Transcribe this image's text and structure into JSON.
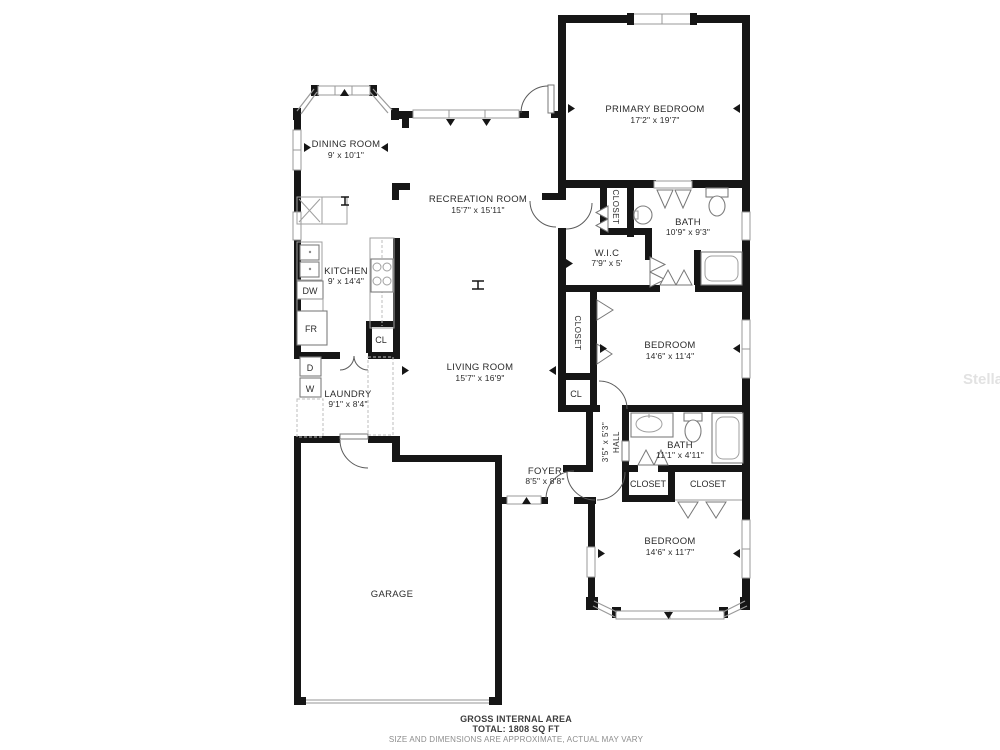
{
  "rooms": {
    "dining": {
      "name": "DINING ROOM",
      "dims": "9' x 10'1\""
    },
    "recreation": {
      "name": "RECREATION ROOM",
      "dims": "15'7\" x 15'11\""
    },
    "primary": {
      "name": "PRIMARY BEDROOM",
      "dims": "17'2\" x 19'7\""
    },
    "primary_closet": {
      "name": "CLOSET"
    },
    "primary_bath": {
      "name": "BATH",
      "dims": "10'9\" x 9'3\""
    },
    "wic": {
      "name": "W.I.C",
      "dims": "7'9\" x 5'"
    },
    "kitchen": {
      "name": "KITCHEN",
      "dims": "9' x 14'4\""
    },
    "kitchen_cl": {
      "name": "CL"
    },
    "living": {
      "name": "LIVING ROOM",
      "dims": "15'7\" x 16'9\""
    },
    "laundry": {
      "name": "LAUNDRY",
      "dims": "9'1\" x 8'4\""
    },
    "hall_closet": {
      "name": "CLOSET"
    },
    "hall_cl": {
      "name": "CL"
    },
    "bedroom2": {
      "name": "BEDROOM",
      "dims": "14'6\" x 11'4\""
    },
    "hall": {
      "name": "HALL",
      "dims": "3'5\" x 5'3\""
    },
    "bath2": {
      "name": "BATH",
      "dims": "11'1\" x 4'11\""
    },
    "foyer": {
      "name": "FOYER",
      "dims": "8'5\" x 8'8\""
    },
    "closet_left": {
      "name": "CLOSET"
    },
    "closet_right": {
      "name": "CLOSET"
    },
    "bedroom3": {
      "name": "BEDROOM",
      "dims": "14'6\" x 11'7\""
    },
    "garage": {
      "name": "GARAGE"
    }
  },
  "appliances": {
    "dishwasher": "DW",
    "fridge": "FR",
    "dryer": "D",
    "washer": "W"
  },
  "footer": {
    "line1": "GROSS INTERNAL AREA",
    "line2": "TOTAL: 1808 SQ FT",
    "line3": "SIZE AND DIMENSIONS ARE APPROXIMATE, ACTUAL MAY VARY"
  },
  "watermark": "Stellar"
}
